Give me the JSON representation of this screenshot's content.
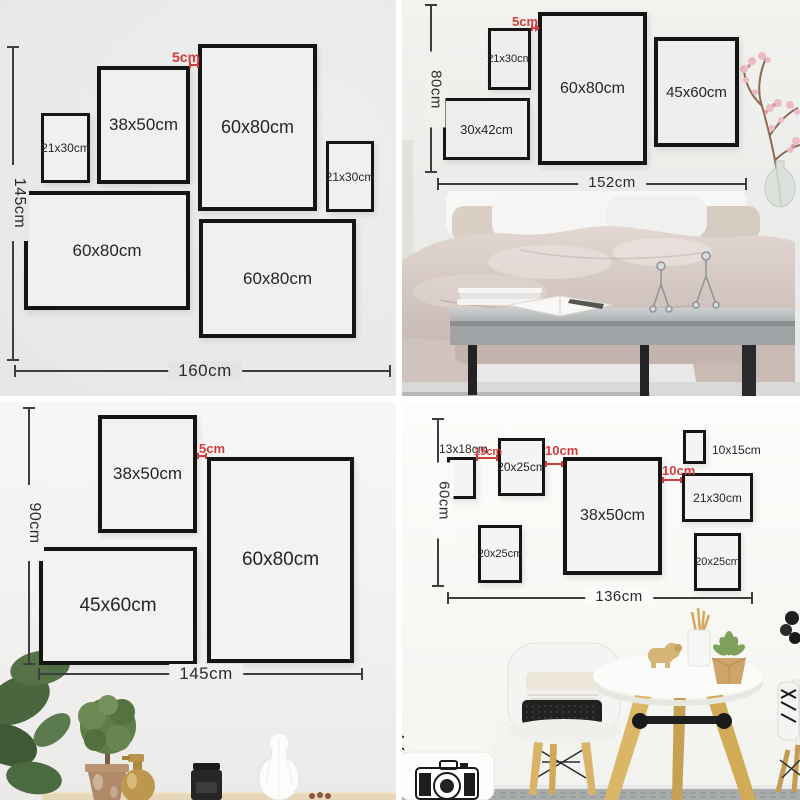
{
  "accent_red": "#d23c3c",
  "frame_border_color": "#151515",
  "quadrants": {
    "top_left": {
      "height_label": "145cm",
      "width_label": "160cm",
      "gap_label": "5cm",
      "frames": [
        {
          "label": "21x30cm"
        },
        {
          "label": "38x50cm"
        },
        {
          "label": "60x80cm"
        },
        {
          "label": "21x30cm"
        },
        {
          "label": "60x80cm"
        },
        {
          "label": "60x80cm"
        }
      ]
    },
    "top_right": {
      "height_label": "80cm",
      "width_label": "152cm",
      "gap_label": "5cm",
      "frames": [
        {
          "label": "21x30cm"
        },
        {
          "label": "60x80cm"
        },
        {
          "label": "45x60cm"
        },
        {
          "label": "30x42cm"
        }
      ]
    },
    "bottom_left": {
      "height_label": "90cm",
      "width_label": "145cm",
      "gap_label": "5cm",
      "frames": [
        {
          "label": "38x50cm"
        },
        {
          "label": "60x80cm"
        },
        {
          "label": "45x60cm"
        }
      ]
    },
    "bottom_right": {
      "height_label": "60cm",
      "width_label": "136cm",
      "gap_labels": [
        "15cm",
        "10cm",
        "10cm"
      ],
      "frames": [
        {
          "label": "13x18cm"
        },
        {
          "label": "20x25cm"
        },
        {
          "label": "38x50cm"
        },
        {
          "label": "10x15cm"
        },
        {
          "label": "21x30cm"
        },
        {
          "label": "20x25cm"
        },
        {
          "label": "20x25cm"
        }
      ]
    }
  }
}
